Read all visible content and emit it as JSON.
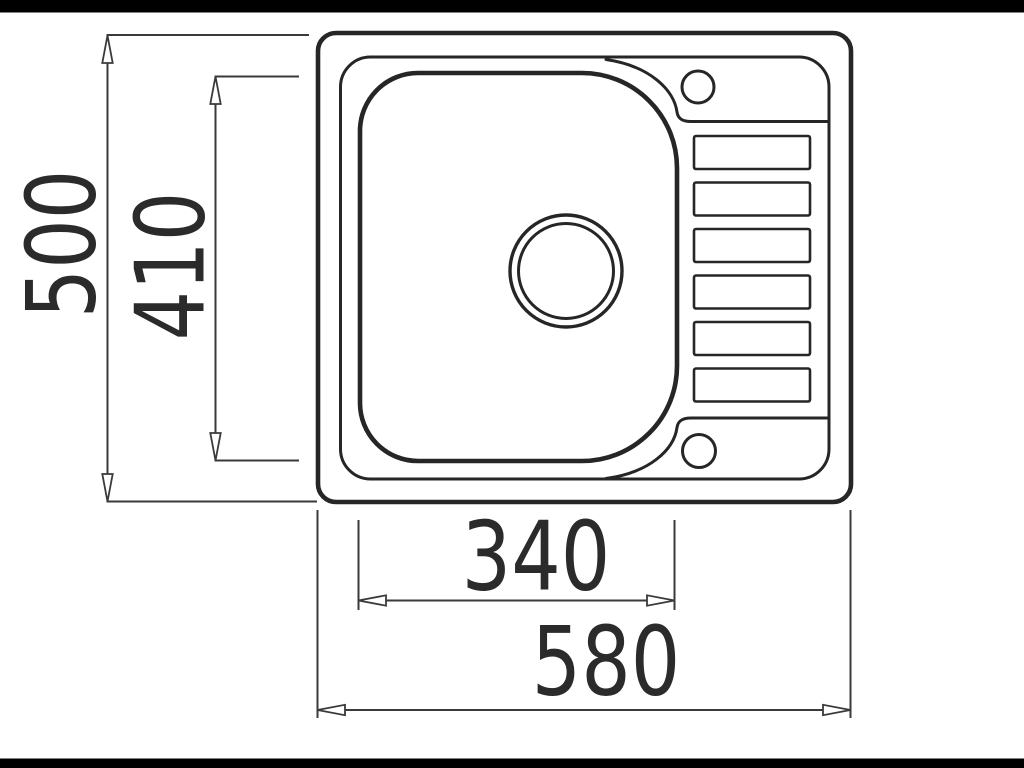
{
  "diagram": {
    "kind": "sink-top-view-technical-drawing"
  },
  "dimensions": {
    "overall_depth": {
      "label": "500"
    },
    "bowl_depth": {
      "label": "410"
    },
    "bowl_width": {
      "label": "340"
    },
    "overall_width": {
      "label": "580"
    }
  },
  "drainer": {
    "groove_count": 6
  },
  "holes": {
    "tap_hole": 1,
    "accessory_hole": 1,
    "waste_drain": 1
  },
  "colors": {
    "line": "#262626",
    "dimension_line": "#3a3a3a",
    "label": "#2b2b2b",
    "background": "#ffffff",
    "letterbox": "#000000"
  }
}
